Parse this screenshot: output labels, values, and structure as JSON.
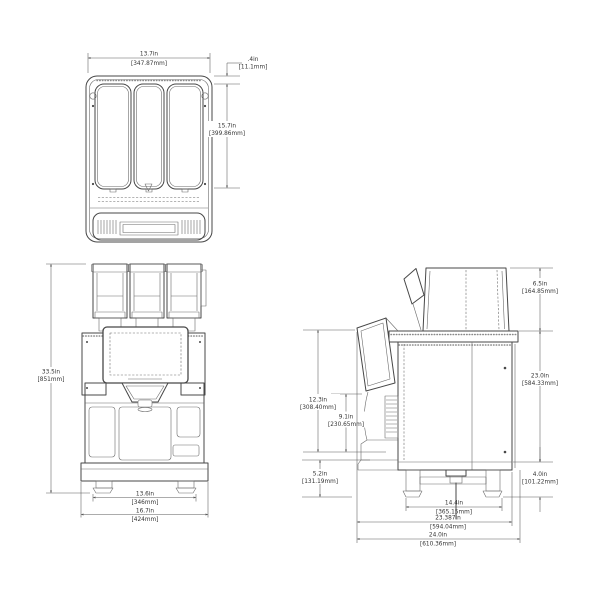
{
  "colors": {
    "background": "#ffffff",
    "line": "#474747",
    "dim_line": "#5a5a5a",
    "text": "#333333"
  },
  "dimensions": {
    "top_view": {
      "width": {
        "in": "13.7in",
        "mm": "[347.87mm]"
      },
      "lid_offset": {
        "in": ".4in",
        "mm": "[11.1mm]"
      },
      "depth": {
        "in": "15.7in",
        "mm": "[399.86mm]"
      }
    },
    "front_view": {
      "overall_height": {
        "in": "33.5in",
        "mm": "[851mm]"
      },
      "foot_span": {
        "in": "13.6in",
        "mm": "[346mm]"
      },
      "overall_width": {
        "in": "16.7in",
        "mm": "[424mm]"
      }
    },
    "side_view": {
      "hopper_height": {
        "in": "6.5in",
        "mm": "[164.85mm]"
      },
      "cabinet_height": {
        "in": "23.0in",
        "mm": "[584.33mm]"
      },
      "base_height": {
        "in": "4.0in",
        "mm": "[101.22mm]"
      },
      "front_height": {
        "in": "12.3in",
        "mm": "[308.40mm]"
      },
      "dispense_height": {
        "in": "9.1in",
        "mm": "[230.65mm]"
      },
      "lower_front_height": {
        "in": "5.2in",
        "mm": "[131.19mm]"
      },
      "foot_span": {
        "in": "14.4in",
        "mm": "[365.15mm]"
      },
      "body_depth": {
        "in": "23.387in",
        "mm": "[594.04mm]"
      },
      "overall_depth": {
        "in": "24.0in",
        "mm": "[610.36mm]"
      }
    }
  }
}
